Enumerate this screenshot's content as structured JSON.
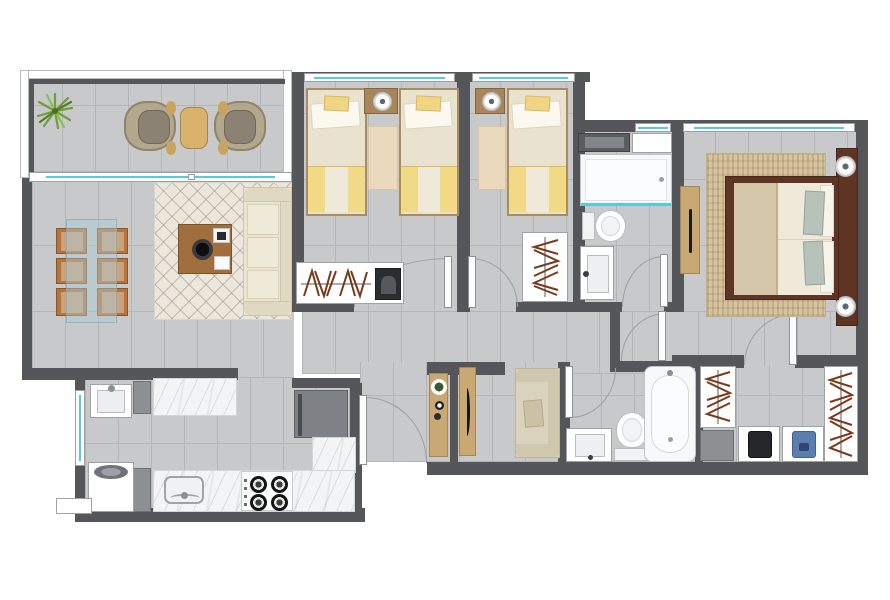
{
  "meta": {
    "kind": "residential-apartment-floor-plan",
    "view": "top-down-3d-render",
    "visible_text": "none",
    "canvas": {
      "width": 890,
      "height": 600,
      "background": "#ffffff"
    }
  },
  "palette": {
    "wall": "#54565a",
    "floor_tile": "#c7c9ca",
    "tile_grout": "#b3b5b7",
    "window_glass": "#53ccdf",
    "marble_counter": "#f3f4f6",
    "light_wood": "#c9a877",
    "chair_wood": "#b5743e",
    "master_bed_wood": "#5e3424",
    "linen": "#ece5d2",
    "accent_yellow": "#f0d584",
    "sage_pillow": "#b6c2ba",
    "sofa_cream": "#eae3d0",
    "rug_cream": "#ece7dd",
    "rug_jute": "#d7c49e",
    "hanger_brown": "#7a3a1c",
    "appliance_gray": "#7e8185",
    "plant_green": "#6f9e3a",
    "denim_blue": "#5b7db0",
    "clothes_black": "#24262a"
  },
  "rooms": [
    {
      "name": "balcony",
      "position": "top-left",
      "furniture": [
        "potted-plant",
        "rattan-lounge-chair",
        "wood-side-table",
        "rattan-lounge-chair"
      ],
      "features": [
        "white-railing",
        "sliding-glass-door"
      ]
    },
    {
      "name": "living-dining-room",
      "position": "left",
      "furniture": [
        "glass-dining-table",
        "six-dining-chairs",
        "lattice-area-rug",
        "coffee-table-with-decor",
        "three-seat-sofa"
      ]
    },
    {
      "name": "bedroom-1",
      "position": "top-center",
      "furniture": [
        "single-bed",
        "single-bed",
        "shared-nightstand-with-lamp",
        "bedside-rug",
        "closet-with-hangers-and-folded-item"
      ],
      "bed_count": 2,
      "features": [
        "window",
        "hinged-door"
      ]
    },
    {
      "name": "bedroom-2",
      "position": "top-center-right",
      "furniture": [
        "single-bed",
        "nightstand-with-lamp",
        "bedside-rug",
        "closet-with-hangers"
      ],
      "bed_count": 1,
      "features": [
        "window",
        "hinged-door"
      ]
    },
    {
      "name": "bathroom-2",
      "position": "center-right",
      "furniture": [
        "storage-cabinet",
        "shower-with-glass-screen",
        "toilet",
        "vanity-sink"
      ],
      "features": [
        "small-window",
        "hinged-door"
      ]
    },
    {
      "name": "master-bedroom",
      "position": "top-right",
      "furniture": [
        "double-bed-dark-wood-frame",
        "integrated-headboard-panel",
        "nightstand-lamp",
        "nightstand-lamp",
        "jute-rug",
        "wall-console"
      ],
      "features": [
        "wide-window"
      ]
    },
    {
      "name": "master-bathroom",
      "position": "bottom-right-center",
      "furniture": [
        "vanity-sink",
        "toilet",
        "bathtub"
      ],
      "features": [
        "hinged-door"
      ]
    },
    {
      "name": "walk-in-closet",
      "position": "bottom-right",
      "furniture": [
        "hanging-rack",
        "gray-storage-box",
        "shelf-black-clothes",
        "shelf-denim-clothes",
        "hanging-rack"
      ],
      "features": [
        "hinged-door"
      ]
    },
    {
      "name": "kitchen",
      "position": "bottom-left",
      "furniture": [
        "marble-counter",
        "refrigerator",
        "l-shaped-marble-counter",
        "kitchen-sink",
        "gas-stove-4-burners",
        "tall-gray-cabinet",
        "tall-gray-cabinet"
      ],
      "burner_count": 4
    },
    {
      "name": "laundry",
      "position": "bottom-far-left",
      "furniture": [
        "laundry-sink",
        "top-load-washer",
        "exterior-ledge"
      ],
      "features": [
        "tall-window"
      ]
    },
    {
      "name": "hallway-entry",
      "position": "bottom-center",
      "furniture": [
        "entry-console-with-bowl",
        "partition-wall",
        "sideboard-with-handle",
        "two-seat-settee"
      ],
      "features": [
        "entry-door",
        "door-arcs"
      ]
    }
  ],
  "counts": {
    "bedrooms": 3,
    "bathrooms": 2,
    "single_beds": 3,
    "double_beds": 1,
    "dining_chairs": 6,
    "doors_swing": 7,
    "sliding_doors": 1,
    "windows": 5
  }
}
